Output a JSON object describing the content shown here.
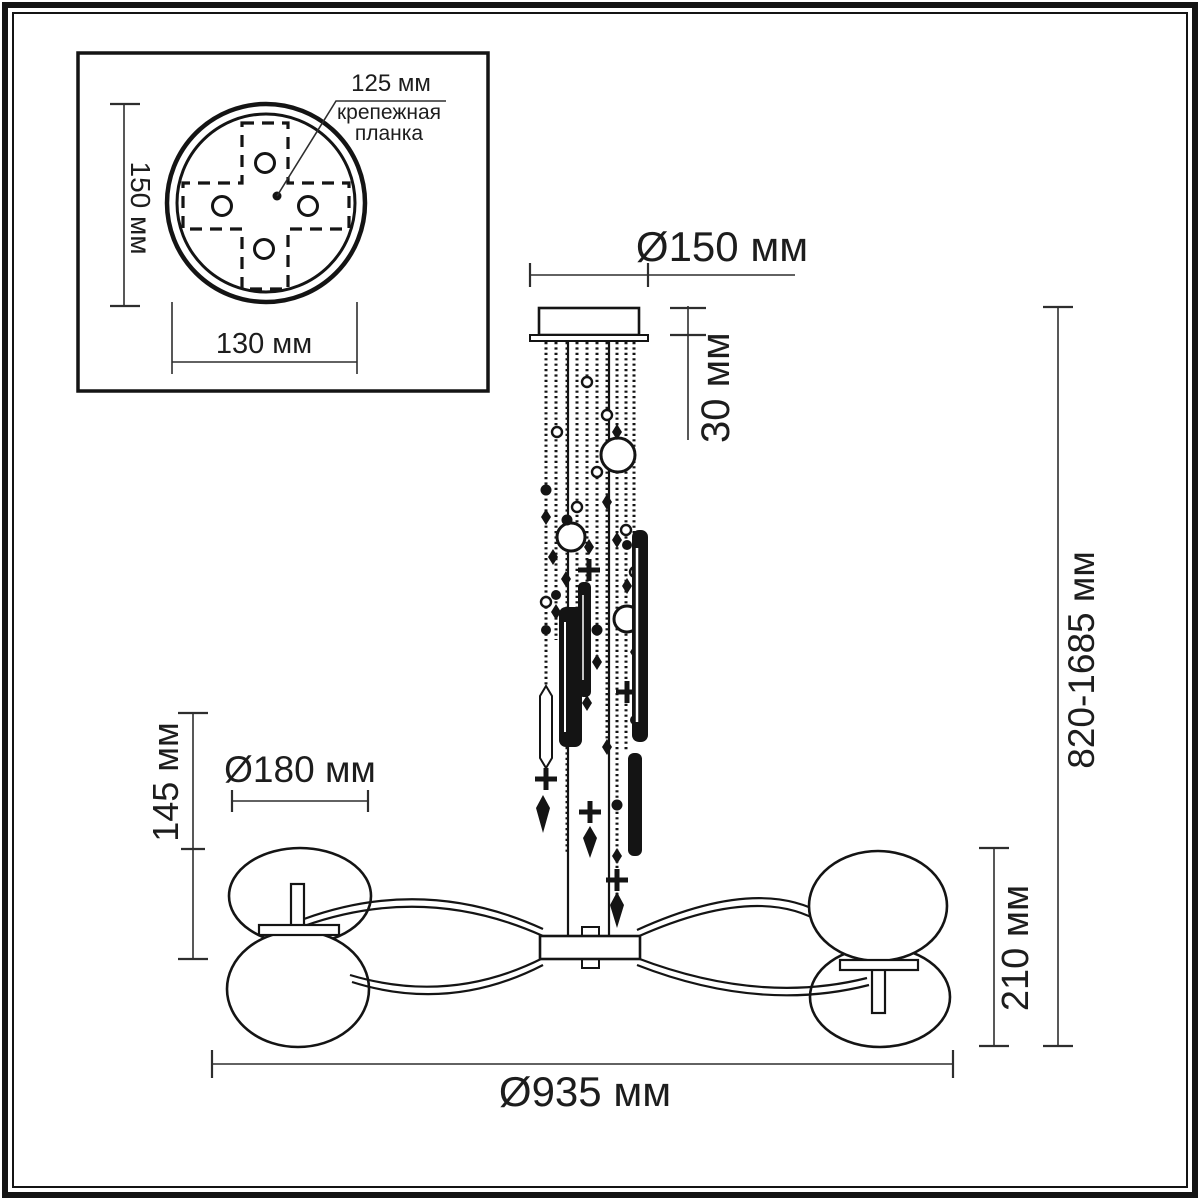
{
  "inset": {
    "dim_125": "125 мм",
    "mount_line1": "крепежная",
    "mount_line2": "планка",
    "dim_150": "150 мм",
    "dim_130": "130 мм"
  },
  "dims": {
    "canopy_diameter": "Ø150 мм",
    "canopy_height": "30 мм",
    "total_height": "820-1685 мм",
    "lamp_height": "145 мм",
    "shade_diameter": "Ø180 мм",
    "body_height": "210 мм",
    "total_diameter": "Ø935 мм"
  },
  "colors": {
    "line": "#141414",
    "dim_line": "#2e2e2e",
    "background": "#ffffff"
  }
}
